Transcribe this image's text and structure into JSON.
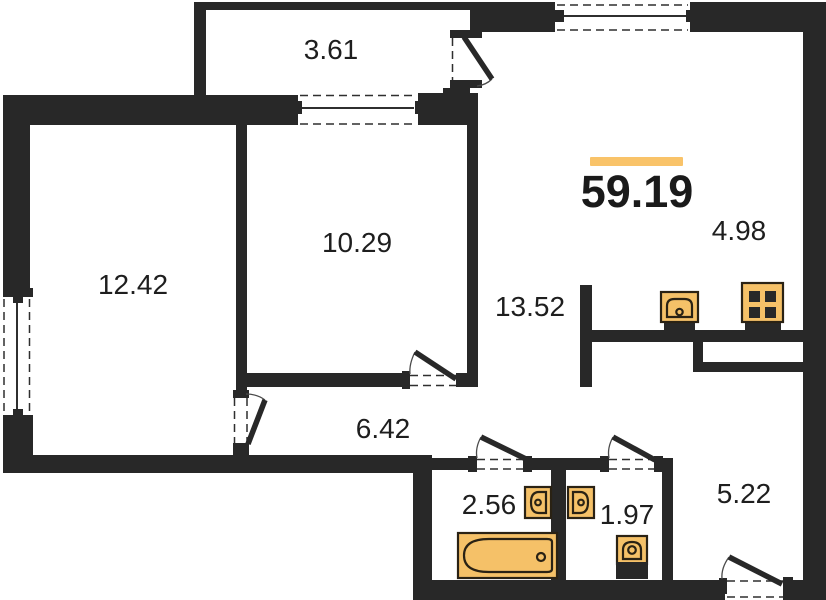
{
  "summary": {
    "total_area": "59.19"
  },
  "rooms": [
    {
      "id": "balcony",
      "area": "3.61"
    },
    {
      "id": "room-1",
      "area": "12.42"
    },
    {
      "id": "room-2",
      "area": "10.29"
    },
    {
      "id": "living-area",
      "area": "13.52"
    },
    {
      "id": "kitchen",
      "area": "4.98"
    },
    {
      "id": "corridor",
      "area": "6.42"
    },
    {
      "id": "bathroom",
      "area": "2.56"
    },
    {
      "id": "wc",
      "area": "1.97"
    },
    {
      "id": "hallway",
      "area": "5.22"
    }
  ],
  "colors": {
    "wall": "#282828",
    "accent_bar": "#F9C369",
    "fixture": "#F5C168",
    "text": "#1E1E1E",
    "background": "#FFFFFF"
  },
  "icons": [
    "kitchen-sink-icon",
    "stove-icon",
    "bathtub-icon",
    "wash-basin-icon",
    "wash-basin-icon",
    "toilet-icon"
  ]
}
